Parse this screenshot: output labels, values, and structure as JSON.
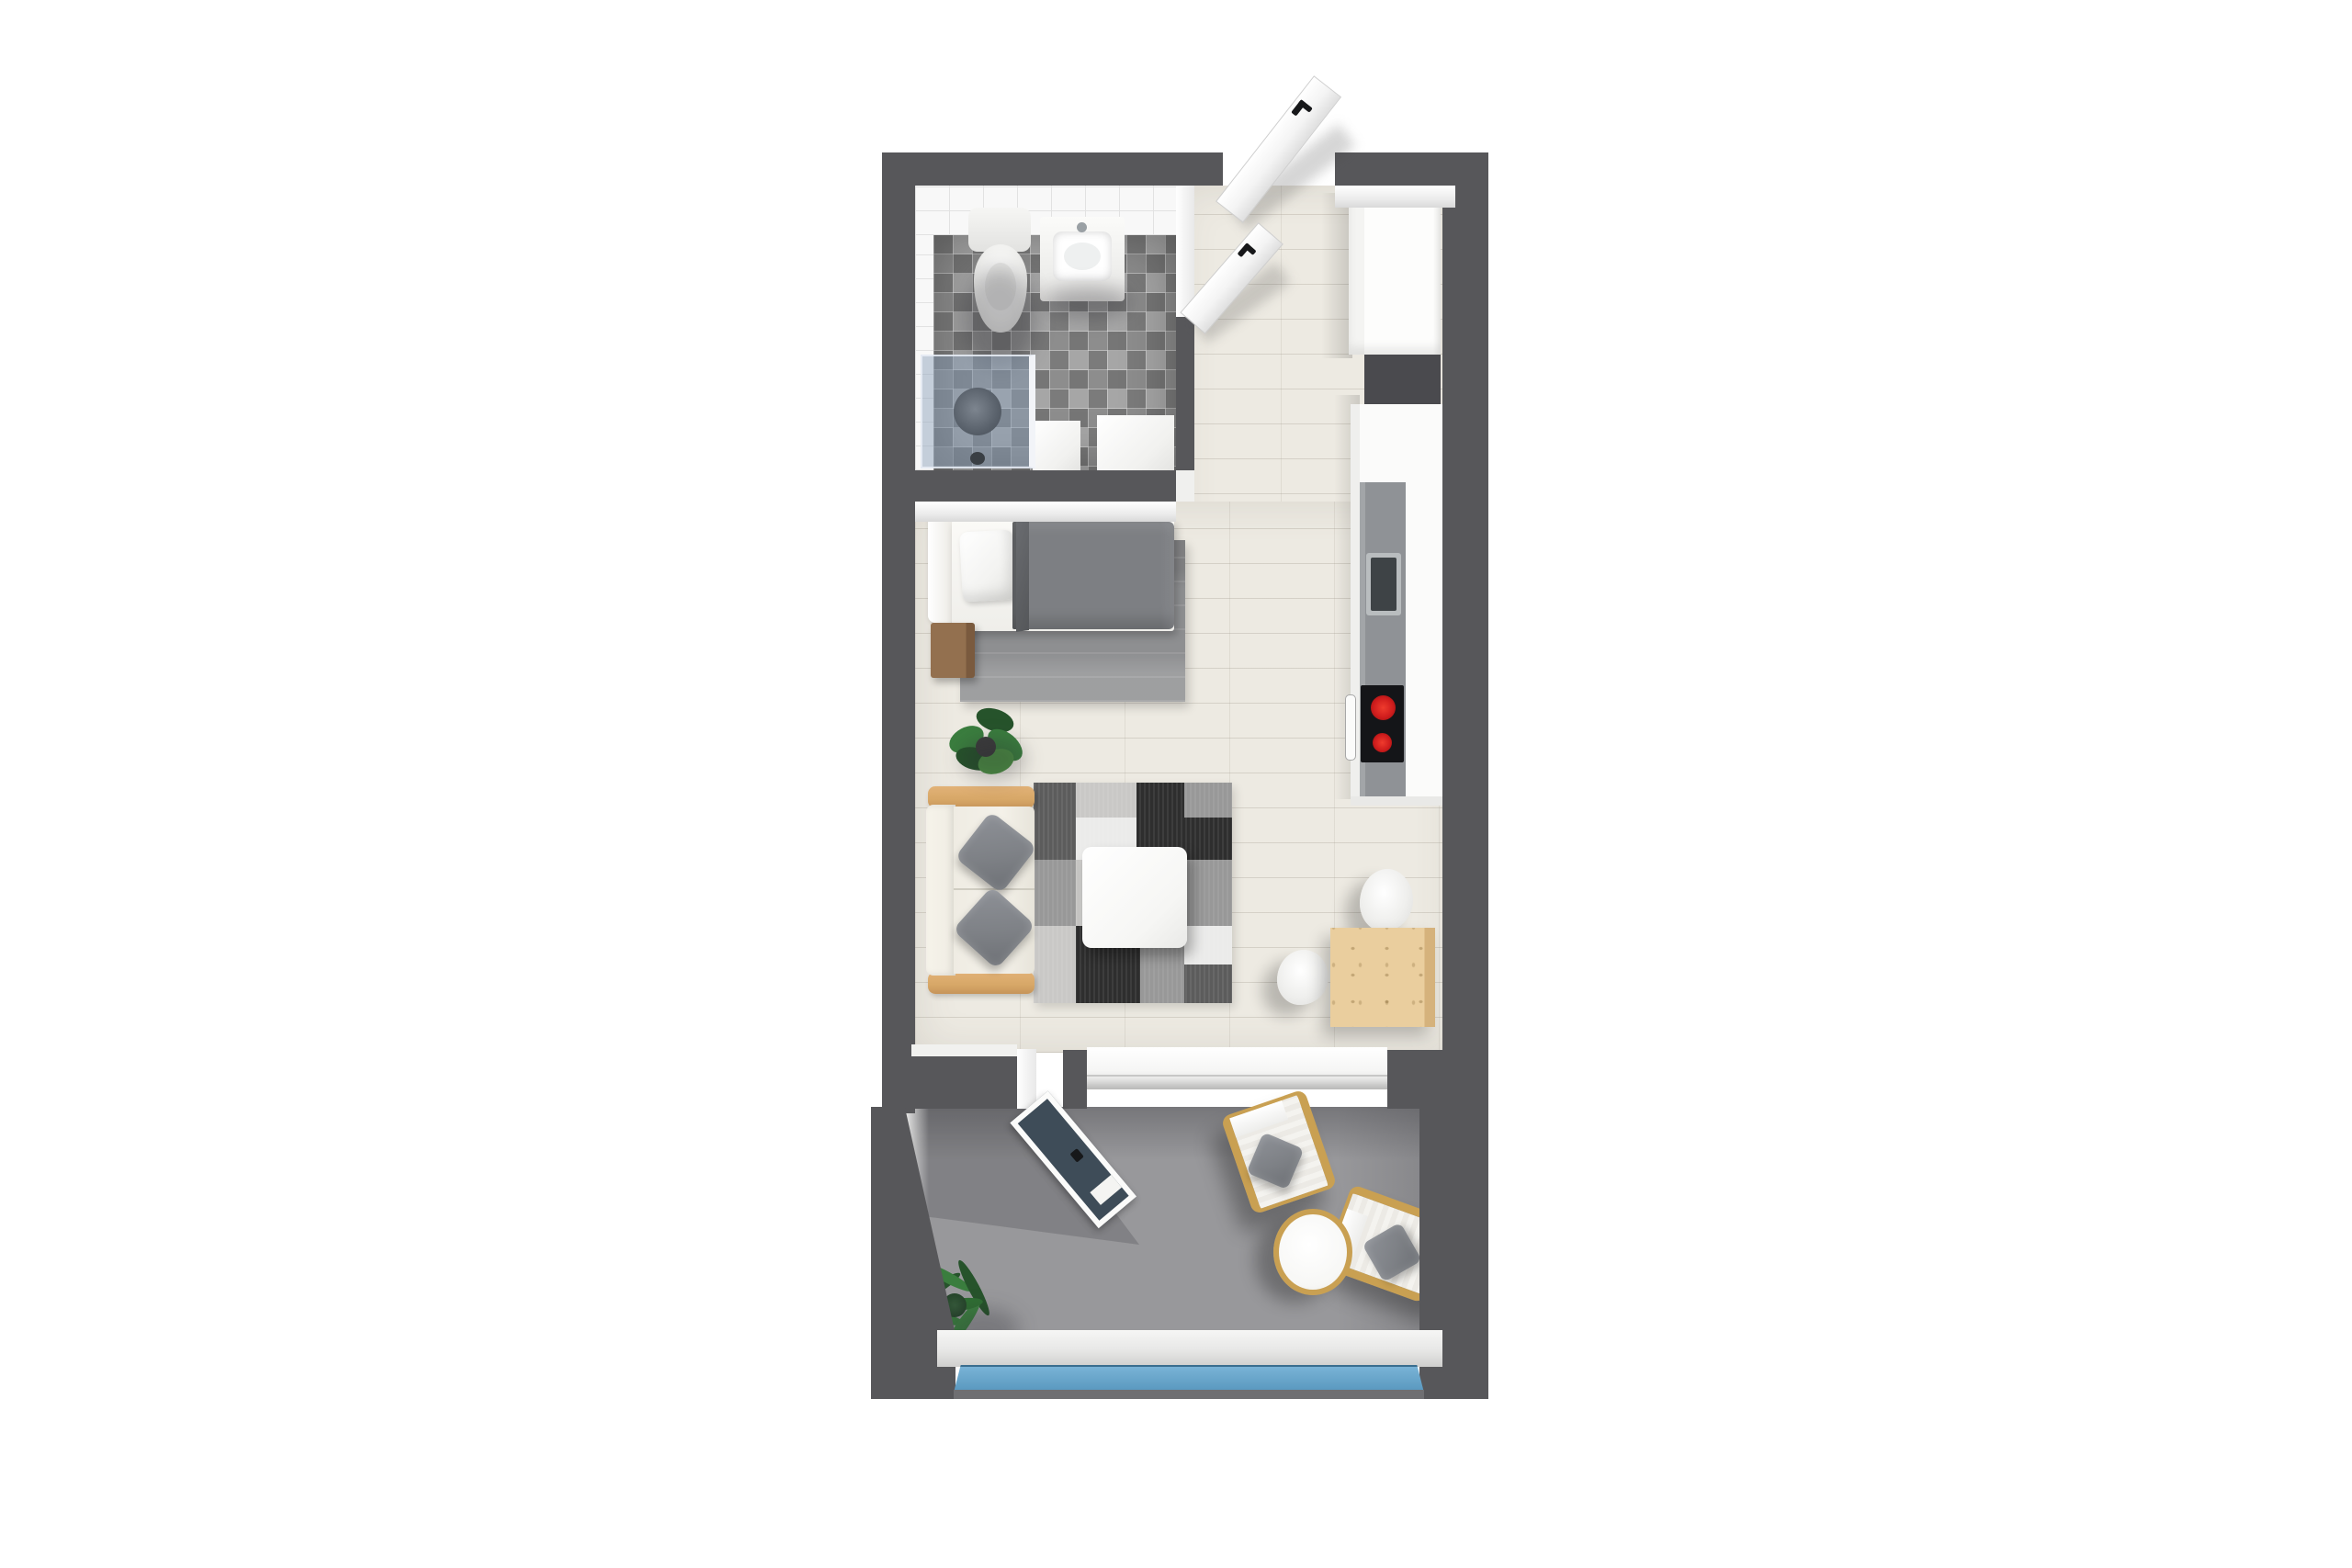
{
  "scene": {
    "type": "3d-floor-plan-rendering",
    "view": "top-down",
    "rooms": [
      {
        "name": "bathroom",
        "fixtures": [
          "toilet",
          "sink-vanity",
          "walk-in-shower",
          "storage-block",
          "washer-block"
        ]
      },
      {
        "name": "entry-hallway",
        "fixtures": [
          "entry-door",
          "bathroom-door",
          "tall-wardrobe-cabinet"
        ]
      },
      {
        "name": "kitchen",
        "fixtures": [
          "tall-cabinet",
          "wall-cabinets",
          "countertop",
          "kitchen-sink",
          "cooktop",
          "oven-handle"
        ]
      },
      {
        "name": "sleeping-area",
        "fixtures": [
          "single-bed",
          "pillow",
          "duvet",
          "nightstand",
          "area-rug",
          "potted-plant"
        ]
      },
      {
        "name": "living-area",
        "fixtures": [
          "sofa",
          "throw-pillows",
          "patchwork-rug",
          "coffee-table",
          "dining-table",
          "two-chairs"
        ]
      },
      {
        "name": "balcony",
        "fixtures": [
          "sliding-glass-door",
          "lounge-chair",
          "lounge-chair",
          "round-side-table",
          "palm-plant",
          "glass-railing"
        ]
      }
    ]
  },
  "colors": {
    "wall": "#57575a",
    "wall_light": "#6f6f72",
    "floor": "#edeae2",
    "bath_tile": "#f8f8f8",
    "bath_tile_line": "#e2e2e2",
    "bath_floor_dark": "#767676",
    "bath_floor_mid": "#8d8d8d",
    "bath_floor_light": "#a6a6a6",
    "shower_glass": "#8ba0ba",
    "shower_head": "#59616b",
    "balcony_floor": "#98989b",
    "rail_glass_top": "#79b3d6",
    "rail_glass_bottom": "#5796bd",
    "door_glass": "#3e4c58",
    "wood_sofa": "#d7a767",
    "wood_table": "#eace9e",
    "wood_table_side": "#d5b27c",
    "wood_lounge": "#c9a052",
    "rug_bed": "#8e8f91",
    "duvet": "#7d7f83",
    "duvet_fold": "#5e6063",
    "cream": "#efece3",
    "pillow": "#7e8186",
    "counter": "#8f9296",
    "sink": "#3e4346",
    "cooktop": "#141518",
    "burner": "#cf1d1d",
    "patch_black": "#2e2e2e",
    "patch_dark": "#5c5c5c",
    "patch_mid": "#989898",
    "patch_light": "#c9c8c6",
    "patch_white": "#ebebea",
    "plant": "#3a7d3e",
    "plant_dark": "#26532b",
    "pot": "#3c3c3c",
    "nightstand": "#93704f",
    "nightstand_dark": "#7a5a3e"
  }
}
